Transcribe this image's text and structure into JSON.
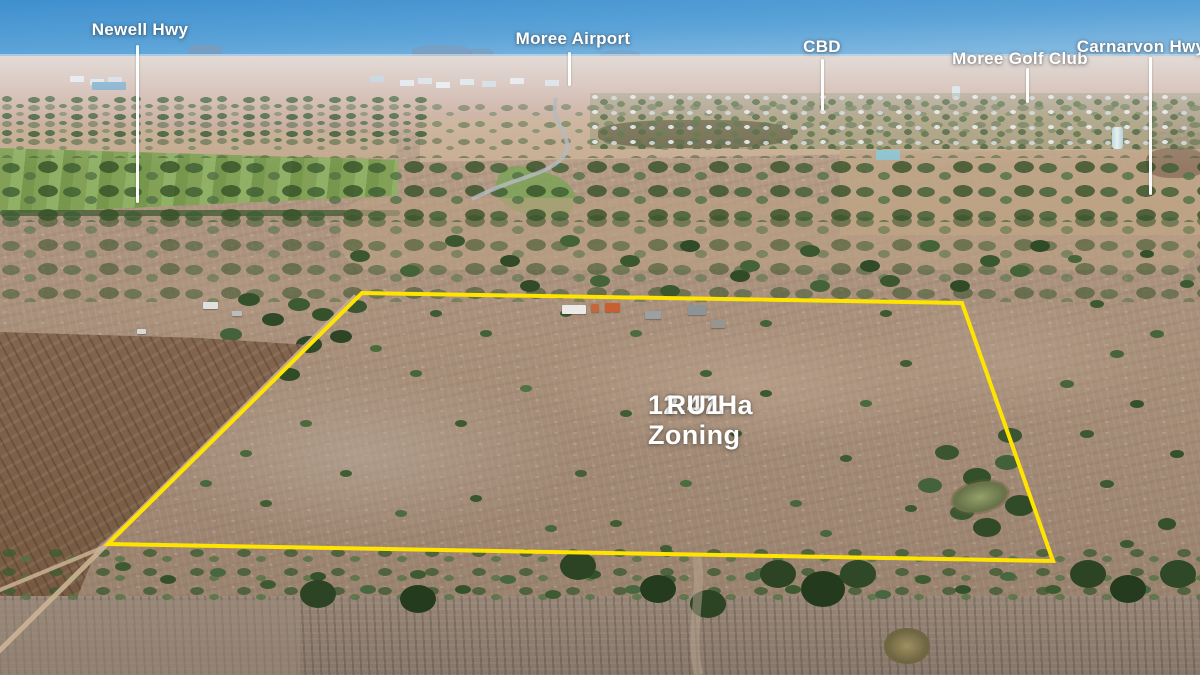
{
  "photo": {
    "landmarks": [
      {
        "id": "newell-hwy",
        "label": "Newell Hwy"
      },
      {
        "id": "moree-airport",
        "label": "Moree Airport"
      },
      {
        "id": "cbd",
        "label": "CBD"
      },
      {
        "id": "moree-golf-club",
        "label": "Moree Golf Club"
      },
      {
        "id": "carnarvon-hwy",
        "label": "Carnarvon Hwy"
      }
    ],
    "parcel": {
      "area": "12.47Ha",
      "zoning": "RU1 Zoning"
    },
    "colors": {
      "boundary": "#FFE400",
      "annotation_text": "#FFFFFF"
    }
  }
}
